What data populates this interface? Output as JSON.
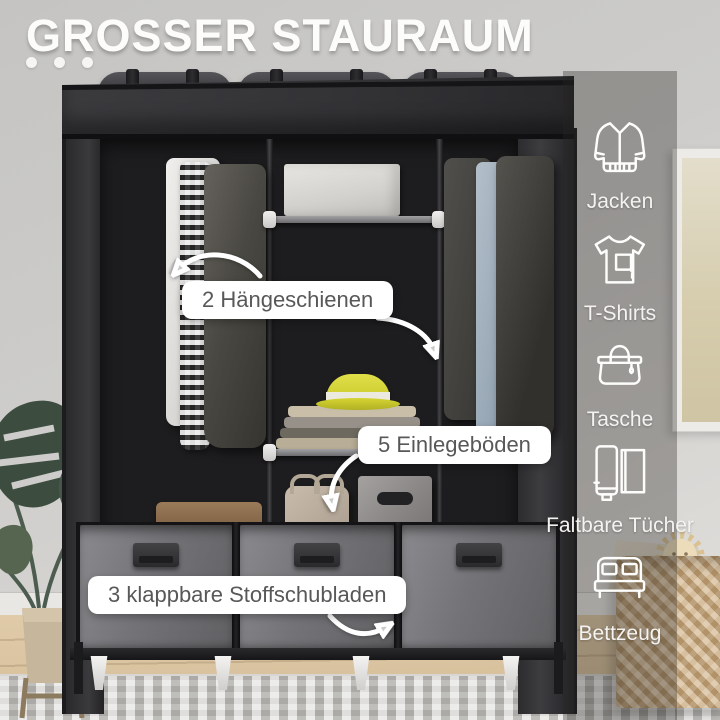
{
  "title": "GROSSER STAURAUM",
  "callouts": {
    "hanging_rails": "2 Hängeschienen",
    "shelves": "5 Einlegeböden",
    "drawers": "3 klappbare Stoffschubladen"
  },
  "features": [
    {
      "icon": "jacket-icon",
      "label": "Jacken"
    },
    {
      "icon": "tshirt-icon",
      "label": "T-Shirts"
    },
    {
      "icon": "handbag-icon",
      "label": "Tasche"
    },
    {
      "icon": "folded-towels-icon",
      "label": "Faltbare Tücher"
    },
    {
      "icon": "bed-icon",
      "label": "Bettzeug"
    }
  ],
  "colors": {
    "wardrobe_fabric": "#2f2f31",
    "drawer_front": "#757478",
    "hat_accent": "#d3d231",
    "callout_bg": "#ffffff",
    "callout_text": "#585858",
    "overlay_band": "rgba(40,38,36,0.34)",
    "icon_stroke": "#fdfdfc",
    "title_color": "#fcfcfb",
    "floor": "#d8c2a0",
    "wall": "#cccbc9"
  }
}
